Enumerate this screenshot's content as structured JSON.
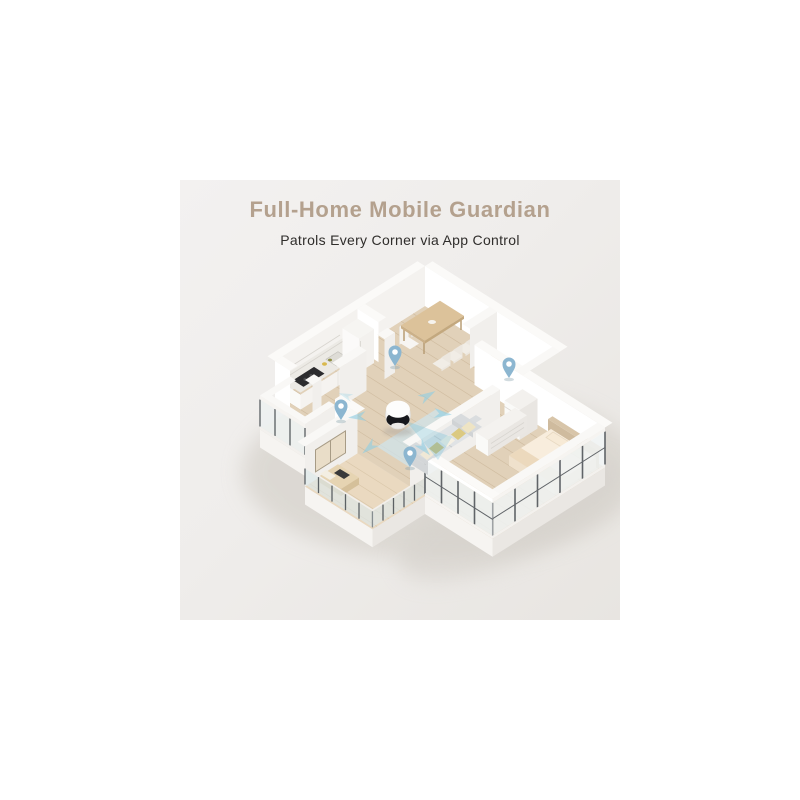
{
  "header": {
    "title": "Full-Home Mobile Guardian",
    "subtitle": "Patrols Every Corner via App Control"
  },
  "colors": {
    "canvas": "#ffffff",
    "panel_background": "#efedeb",
    "title_text": "#b4a18e",
    "subtitle_text": "#2f2d2b",
    "wall_white": "#ffffff",
    "floor_wood": "#e0d0b8",
    "location_pin_blue": "#8cb6d0",
    "patrol_arrow_blue": "#8fcfe4",
    "robot_band_black": "#17181c"
  },
  "scene": {
    "description": "3D isometric apartment floor plan patrolled by a mobile home camera robot",
    "location_pin_count": 4,
    "robot_count": 1
  }
}
